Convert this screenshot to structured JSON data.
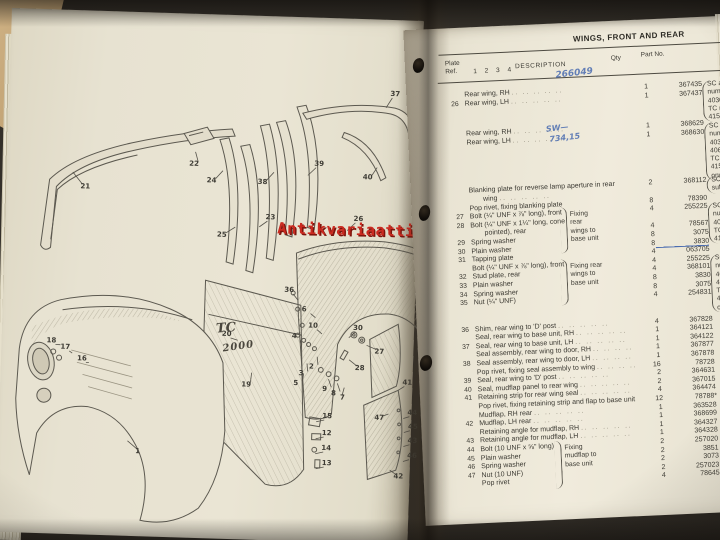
{
  "photo": {
    "colors": {
      "watermark_red": "#cb2a20",
      "handwriting_blue": "#4a6cb0",
      "ink": "#3c3a33",
      "page_cream": "#eae5d4",
      "cover_tan": "#c0a172",
      "background_dark": "#2e2a24"
    }
  },
  "watermark": {
    "text": "Antikvariaatti.net"
  },
  "left_page": {
    "badge": {
      "line1": "TC",
      "line2": "2000"
    },
    "callouts": [
      {
        "n": "21",
        "x": 74,
        "y": 172,
        "dx": -12,
        "dy": -14
      },
      {
        "n": "22",
        "x": 182,
        "y": 146,
        "dx": 2,
        "dy": -12
      },
      {
        "n": "24",
        "x": 200,
        "y": 162,
        "dx": 12,
        "dy": -10
      },
      {
        "n": "25",
        "x": 212,
        "y": 216,
        "dx": 14,
        "dy": -8
      },
      {
        "n": "23",
        "x": 260,
        "y": 197,
        "dx": -10,
        "dy": 10
      },
      {
        "n": "38",
        "x": 251,
        "y": 162,
        "dx": 12,
        "dy": -10
      },
      {
        "n": "39",
        "x": 307,
        "y": 142,
        "dx": -10,
        "dy": 12
      },
      {
        "n": "37",
        "x": 381,
        "y": 70,
        "dx": -8,
        "dy": 14
      },
      {
        "n": "40",
        "x": 356,
        "y": 154,
        "dx": 10,
        "dy": -10
      },
      {
        "n": "26",
        "x": 348,
        "y": 196,
        "dx": -10,
        "dy": 12
      },
      {
        "n": "36",
        "x": 281,
        "y": 269,
        "dx": 10,
        "dy": 10
      },
      {
        "n": "6",
        "x": 299,
        "y": 288,
        "dx": 10,
        "dy": 8
      },
      {
        "n": "10",
        "x": 306,
        "y": 304,
        "dx": 10,
        "dy": 8
      },
      {
        "n": "30",
        "x": 351,
        "y": 305,
        "dx": -8,
        "dy": 10
      },
      {
        "n": "27",
        "x": 373,
        "y": 328,
        "dx": -12,
        "dy": -6
      },
      {
        "n": "28",
        "x": 354,
        "y": 345,
        "dx": -10,
        "dy": -8
      },
      {
        "n": "20",
        "x": 220,
        "y": 315,
        "dx": 12,
        "dy": 6
      },
      {
        "n": "19",
        "x": 241,
        "y": 365,
        "dx": 6,
        "dy": -12
      },
      {
        "n": "4",
        "x": 290,
        "y": 315,
        "dx": 6,
        "dy": 10
      },
      {
        "n": "2",
        "x": 308,
        "y": 345,
        "dx": 4,
        "dy": -10
      },
      {
        "n": "3",
        "x": 298,
        "y": 352,
        "dx": 4,
        "dy": -10
      },
      {
        "n": "5",
        "x": 293,
        "y": 362,
        "dx": 6,
        "dy": -10
      },
      {
        "n": "9",
        "x": 322,
        "y": 367,
        "dx": 2,
        "dy": -10
      },
      {
        "n": "8",
        "x": 331,
        "y": 371,
        "dx": 2,
        "dy": -10
      },
      {
        "n": "7",
        "x": 340,
        "y": 375,
        "dx": 0,
        "dy": -10
      },
      {
        "n": "15",
        "x": 323,
        "y": 394,
        "dx": -10,
        "dy": 6
      },
      {
        "n": "12",
        "x": 323,
        "y": 411,
        "dx": -10,
        "dy": 6
      },
      {
        "n": "14",
        "x": 323,
        "y": 426,
        "dx": -10,
        "dy": 6
      },
      {
        "n": "13",
        "x": 324,
        "y": 441,
        "dx": -10,
        "dy": 6
      },
      {
        "n": "47",
        "x": 375,
        "y": 394,
        "dx": 10,
        "dy": -4
      },
      {
        "n": "41",
        "x": 402,
        "y": 358,
        "dx": -8,
        "dy": 8
      },
      {
        "n": "44",
        "x": 408,
        "y": 388,
        "dx": -8,
        "dy": 6
      },
      {
        "n": "45",
        "x": 409,
        "y": 402,
        "dx": -8,
        "dy": 6
      },
      {
        "n": "43",
        "x": 409,
        "y": 416,
        "dx": -8,
        "dy": 6
      },
      {
        "n": "46",
        "x": 409,
        "y": 431,
        "dx": -8,
        "dy": 6
      },
      {
        "n": "42",
        "x": 396,
        "y": 452,
        "dx": -8,
        "dy": -6
      },
      {
        "n": "18",
        "x": 45,
        "y": 327,
        "dx": 10,
        "dy": 4
      },
      {
        "n": "17",
        "x": 59,
        "y": 333,
        "dx": 8,
        "dy": 6
      },
      {
        "n": "16",
        "x": 76,
        "y": 344,
        "dx": 8,
        "dy": 4
      },
      {
        "n": "1",
        "x": 137,
        "y": 435,
        "dx": -12,
        "dy": -10
      }
    ]
  },
  "right_page": {
    "header": "WINGS, FRONT AND REAR",
    "columns": {
      "plate_line1": "Plate",
      "plate_line2": "Ref.",
      "nums": "1 2 3 4",
      "description": "DESCRIPTION",
      "qty": "Qty",
      "part": "Part No."
    },
    "handwriting": [
      {
        "text": "266049",
        "x": 150,
        "y": 46,
        "small": false
      },
      {
        "text": "SW—",
        "x": 138,
        "y": 100,
        "small": true
      },
      {
        "text": "734,15",
        "x": 141,
        "y": 110,
        "small": true
      }
    ],
    "table": {
      "leader": ".. .. .. .. ..",
      "rows": [
        {
          "ref": "",
          "desc": "Rear wing, RH",
          "qty": "1",
          "part": "367435",
          "dots": true
        },
        {
          "ref": "26",
          "desc": "Rear wing, LH",
          "qty": "1",
          "part": "367437",
          "dots": true
        },
        {
          "ref": "",
          "desc": "Rear wing, RH",
          "qty": "1",
          "part": "368629",
          "dots": true,
          "gap": 22
        },
        {
          "ref": "",
          "desc": "Rear wing, LH",
          "qty": "1",
          "part": "368630",
          "dots": true
        },
        {
          "ref": "",
          "desc": "Blanking plate for reverse lamp aperture in rear",
          "qty": "2",
          "part": "368112",
          "gap": 40
        },
        {
          "ref": "",
          "desc": "wing",
          "indent": 1,
          "dots": true
        },
        {
          "ref": "",
          "desc": "Pop rivet, fixing blanking plate",
          "qty": "8",
          "part": "78390"
        },
        {
          "ref": "27",
          "desc": "Bolt (¼\" UNF x ⅞\" long), front",
          "qty": "4",
          "part": "255225"
        },
        {
          "ref": "28",
          "desc": "Bolt (¼\" UNF x 1¼\" long, cone"
        },
        {
          "ref": "",
          "desc": "pointed), rear",
          "indent": 1,
          "qty": "4",
          "part": "78567"
        },
        {
          "ref": "29",
          "desc": "Spring washer",
          "qty": "8",
          "part": "3075"
        },
        {
          "ref": "30",
          "desc": "Plain washer",
          "qty": "8",
          "part": "3830",
          "mark": true
        },
        {
          "ref": "31",
          "desc": "Tapping plate",
          "qty": "4",
          "part": "063705"
        },
        {
          "ref": "",
          "desc": "Bolt (¼\" UNF x ⅞\" long), front",
          "qty": "4",
          "part": "255225"
        },
        {
          "ref": "32",
          "desc": "Stud plate, rear",
          "qty": "4",
          "part": "368101"
        },
        {
          "ref": "33",
          "desc": "Plain washer",
          "qty": "8",
          "part": "3830"
        },
        {
          "ref": "34",
          "desc": "Spring washer",
          "qty": "8",
          "part": "3075"
        },
        {
          "ref": "35",
          "desc": "Nut (¼\" UNF)",
          "qty": "4",
          "part": "254831"
        },
        {
          "ref": "36",
          "desc": "Shim, rear wing to 'D' post",
          "qty": "4",
          "part": "367828",
          "dots": true,
          "gap": 18
        },
        {
          "ref": "",
          "desc": "Seal, rear wing to base unit, RH",
          "qty": "1",
          "part": "364121",
          "dots": true
        },
        {
          "ref": "37",
          "desc": "Seal, rear wing to base unit, LH",
          "qty": "1",
          "part": "364122",
          "dots": true
        },
        {
          "ref": "",
          "desc": "Seal assembly, rear wing to door, RH",
          "qty": "1",
          "part": "367877",
          "dots": true
        },
        {
          "ref": "38",
          "desc": "Seal assembly, rear wing to door, LH",
          "qty": "1",
          "part": "367878",
          "dots": true
        },
        {
          "ref": "",
          "desc": "Pop rivet, fixing seal assembly to wing",
          "qty": "16",
          "part": "78728",
          "dots": true
        },
        {
          "ref": "39",
          "desc": "Seal, rear wing to 'D' post",
          "qty": "2",
          "part": "364631",
          "dots": true
        },
        {
          "ref": "40",
          "desc": "Seal, mudflap panel to rear wing",
          "qty": "2",
          "part": "367015",
          "dots": true
        },
        {
          "ref": "41",
          "desc": "Retaining strip for rear wing seal",
          "qty": "4",
          "part": "364474",
          "dots": true
        },
        {
          "ref": "",
          "desc": "Pop rivet, fixing retaining strip and flap to base unit",
          "qty": "12",
          "part": "78788*"
        },
        {
          "ref": "",
          "desc": "Mudflap, RH rear",
          "qty": "1",
          "part": "363528",
          "dots": true
        },
        {
          "ref": "42",
          "desc": "Mudflap, LH rear",
          "qty": "1",
          "part": "368699",
          "dots": true
        },
        {
          "ref": "",
          "desc": "Retaining angle for mudflap, RH",
          "qty": "1",
          "part": "364327",
          "dots": true
        },
        {
          "ref": "43",
          "desc": "Retaining angle for mudflap, LH",
          "qty": "1",
          "part": "364328",
          "dots": true
        },
        {
          "ref": "44",
          "desc": "Bolt (10 UNF x ⅝\" long)",
          "qty": "2",
          "part": "257020"
        },
        {
          "ref": "45",
          "desc": "Plain washer",
          "qty": "2",
          "part": "3851"
        },
        {
          "ref": "46",
          "desc": "Spring washer",
          "qty": "2",
          "part": "3073"
        },
        {
          "ref": "47",
          "desc": "Nut (10 UNF)",
          "qty": "2",
          "part": "257023"
        },
        {
          "ref": "",
          "desc": "Pop rivet",
          "qty": "4",
          "part": "78645"
        }
      ]
    },
    "braces": [
      {
        "x": 148,
        "y": 184,
        "h": 46,
        "lines": [
          "Fixing",
          "rear",
          "wings to",
          "base unit"
        ]
      },
      {
        "x": 146,
        "y": 236,
        "h": 46,
        "lines": [
          "Fixing rear",
          "wings to",
          "base unit"
        ]
      },
      {
        "x": 132,
        "y": 417,
        "h": 48,
        "lines": [
          "Fixing",
          "mudflap to",
          "base unit"
        ]
      }
    ],
    "side_notes": [
      {
        "x": 296,
        "y": 64,
        "lines": [
          "SC and Aut",
          "numbered 4",
          "40308814E,",
          "TC models",
          "41502590B,"
        ]
      },
      {
        "x": 296,
        "y": 106,
        "lines": [
          "SC and A",
          "numbered",
          "40300815E,",
          "40600018E,",
          "TC mode",
          "4150259",
          "onwards"
        ]
      },
      {
        "x": 296,
        "y": 160,
        "lines": [
          "SC mod",
          "suffix 'C"
        ]
      },
      {
        "x": 296,
        "y": 186,
        "lines": [
          "SC and",
          "number",
          "4030881",
          "TC mo",
          "415025"
        ]
      },
      {
        "x": 296,
        "y": 238,
        "lines": [
          "SC an",
          "numb",
          "40308",
          "40300",
          "TC m",
          "41502",
          "onwa"
        ]
      }
    ]
  }
}
